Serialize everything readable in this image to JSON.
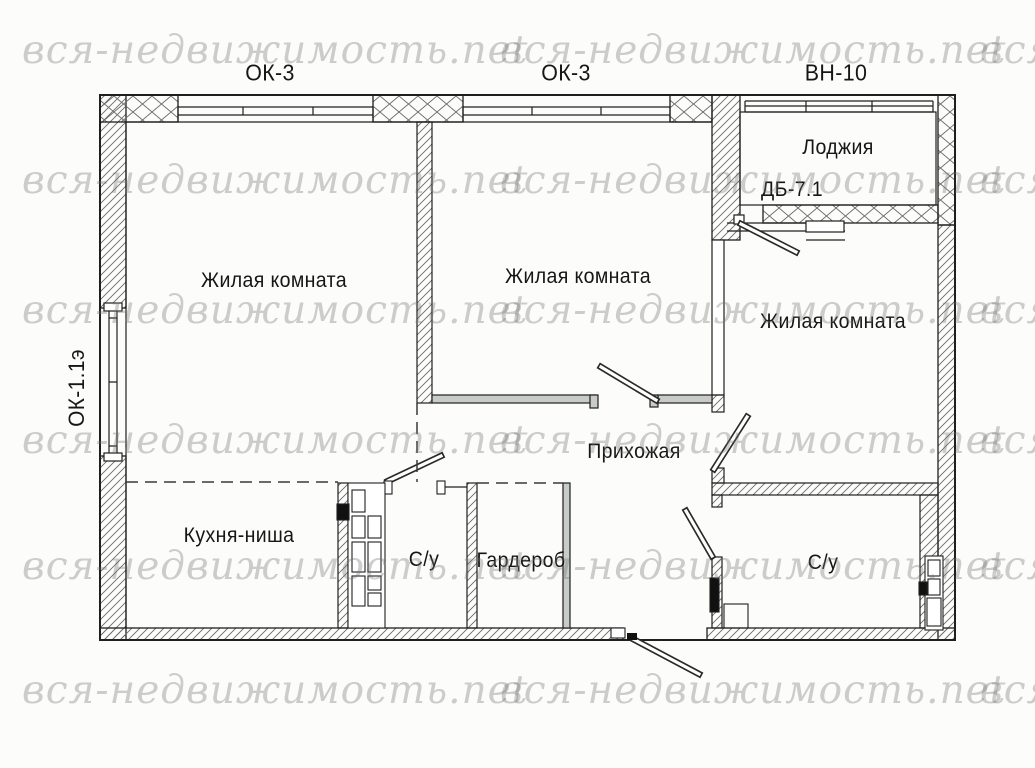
{
  "watermark": {
    "text": "вся-недвижимость.net"
  },
  "plan": {
    "windows": {
      "top_left_mark": "ОК-3",
      "top_middle_mark": "ОК-3",
      "loggia_mark": "ВН-10",
      "left_mark": "ОК-1.1э"
    },
    "rooms": {
      "living1": "Жилая комната",
      "living2": "Жилая комната",
      "living3": "Жилая комната",
      "hallway": "Прихожая",
      "kitchen": "Кухня-ниша",
      "bathroom_left": "С/у",
      "bathroom_right": "С/у",
      "wardrobe": "Гардероб",
      "loggia": "Лоджия",
      "loggia_door_mark": "ДБ-7.1"
    }
  }
}
